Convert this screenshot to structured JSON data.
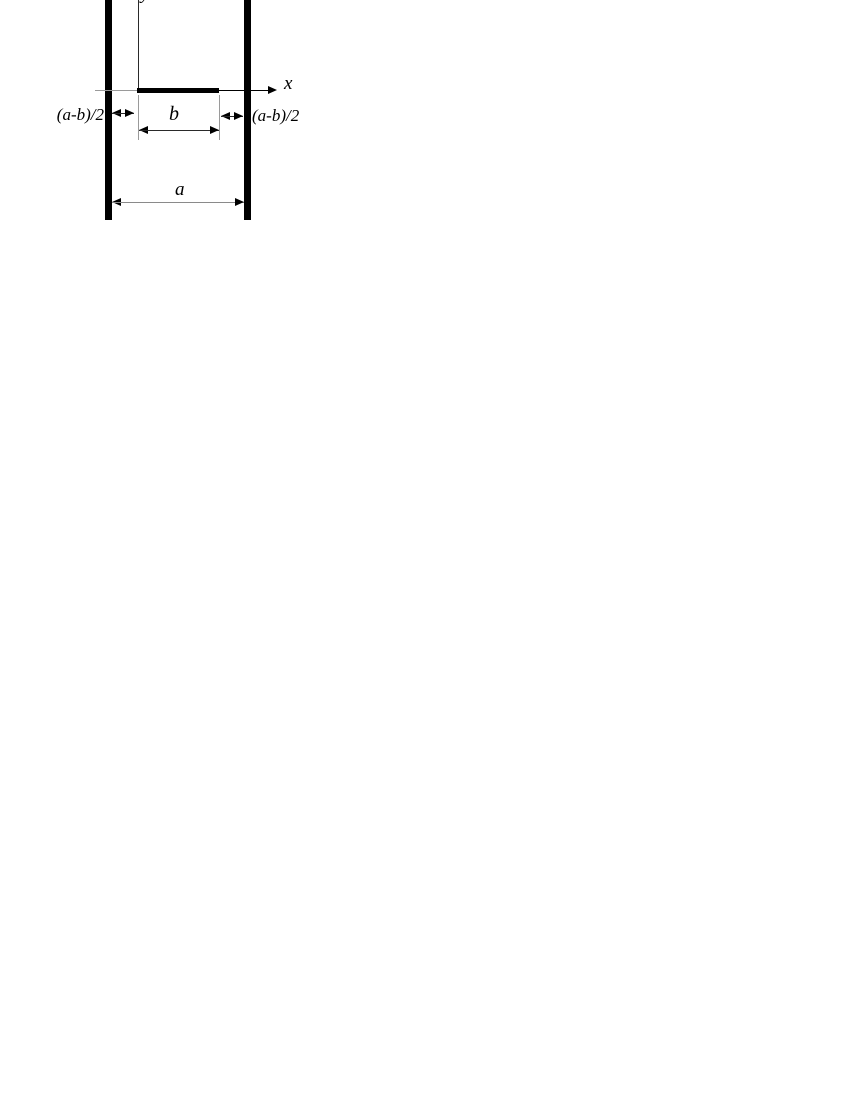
{
  "figure": {
    "description": "Cross-section schematic: a conducting strip of width b centered between two plates of width a, with coordinate axes",
    "background_color": "#ffffff",
    "ink_color": "#000000",
    "guide_line_color": "#9a9a9a",
    "labels": {
      "y_axis": "y",
      "x_axis": "x",
      "strip_width": "b",
      "plate_width": "a",
      "left_gap": "(a-b)/2",
      "right_gap": "(a-b)/2"
    }
  }
}
